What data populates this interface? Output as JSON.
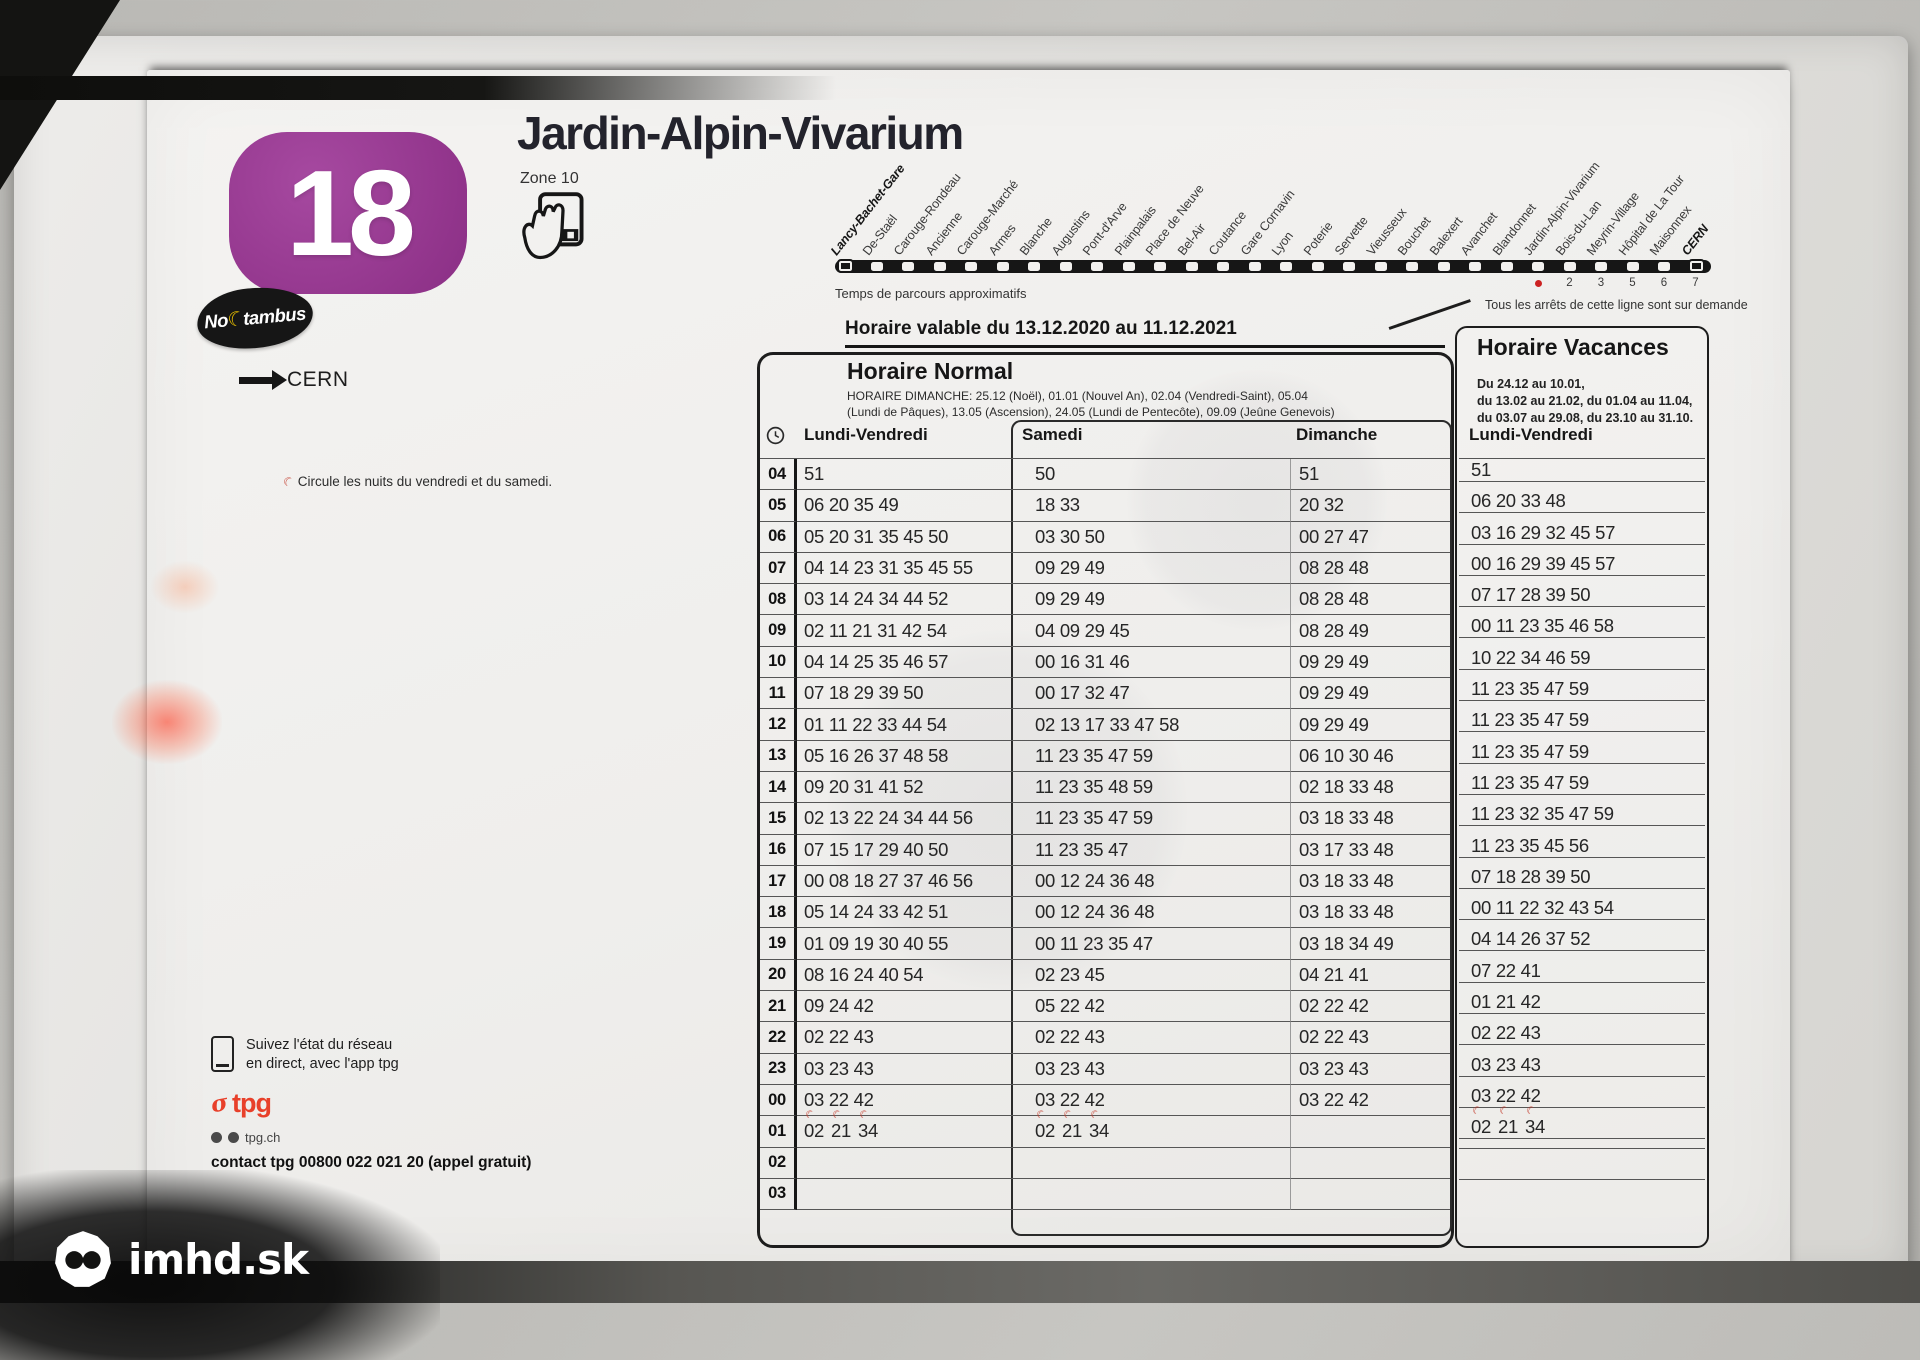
{
  "watermark": {
    "text": "imhd.sk"
  },
  "header": {
    "line_number": "18",
    "line_color": "#93368d",
    "title": "Jardin-Alpin-Vivarium",
    "zone": "Zone 10",
    "noctambus_prefix": "No",
    "noctambus_suffix": "tambus",
    "direction_label": "CERN",
    "night_note": "Circule les nuits du vendredi et du samedi."
  },
  "route": {
    "stops": [
      "Lancy-Bachet-Gare",
      "De-Staël",
      "Carouge-Rondeau",
      "Ancienne",
      "Carouge-Marché",
      "Armes",
      "Blanche",
      "Augustins",
      "Pont-d'Arve",
      "Plainpalais",
      "Place de Neuve",
      "Bel-Air",
      "Coutance",
      "Gare Cornavin",
      "Lyon",
      "Poterie",
      "Servette",
      "Vieusseux",
      "Bouchet",
      "Balexert",
      "Avanchet",
      "Blandonnet",
      "Jardin-Alpin-Vivarium",
      "Bois-du-Lan",
      "Meyrin-Village",
      "Hôpital de La Tour",
      "Maisonnex",
      "CERN"
    ],
    "travel_note": "Temps de parcours approximatifs",
    "minute_marks": [
      "•",
      "2",
      "3",
      "5",
      "6",
      "7"
    ],
    "demand_note": "Tous les arrêts de cette ligne sont sur demande"
  },
  "validity": "Horaire valable du 13.12.2020 au 11.12.2021",
  "normal": {
    "title": "Horaire Normal",
    "note_line1": "HORAIRE DIMANCHE: 25.12 (Noël), 01.01 (Nouvel An), 02.04 (Vendredi-Saint), 05.04",
    "note_line2": "(Lundi de Pâques), 13.05 (Ascension), 24.05 (Lundi de Pentecôte), 09.09 (Jeûne Genevois)"
  },
  "vacances": {
    "title": "Horaire Vacances",
    "dates_line1": "Du 24.12 au 10.01,",
    "dates_line2": "du 13.02 au 21.02, du 01.04 au 11.04,",
    "dates_line3": "du 03.07 au 29.08, du 23.10 au 31.10."
  },
  "timetable": {
    "col_lv": "Lundi-Vendredi",
    "col_sa": "Samedi",
    "col_di": "Dimanche",
    "col_vac": "Lundi-Vendredi",
    "rows": [
      {
        "hour": "04",
        "lv": "51",
        "sa": "50",
        "di": "51",
        "vac": "51"
      },
      {
        "hour": "05",
        "lv": "06 20 35 49",
        "sa": "18 33",
        "di": "20 32",
        "vac": "06 20 33 48"
      },
      {
        "hour": "06",
        "lv": "05 20 31 35 45 50",
        "sa": "03 30 50",
        "di": "00 27 47",
        "vac": "03 16 29 32 45 57"
      },
      {
        "hour": "07",
        "lv": "04 14 23 31 35 45 55",
        "sa": "09 29 49",
        "di": "08 28 48",
        "vac": "00 16 29 39 45 57"
      },
      {
        "hour": "08",
        "lv": "03 14 24 34 44 52",
        "sa": "09 29 49",
        "di": "08 28 48",
        "vac": "07 17 28 39 50"
      },
      {
        "hour": "09",
        "lv": "02 11 21 31 42 54",
        "sa": "04 09 29 45",
        "di": "08 28 49",
        "vac": "00 11 23 35 46 58"
      },
      {
        "hour": "10",
        "lv": "04 14 25 35 46 57",
        "sa": "00 16 31 46",
        "di": "09 29 49",
        "vac": "10 22 34 46 59"
      },
      {
        "hour": "11",
        "lv": "07 18 29 39 50",
        "sa": "00 17 32 47",
        "di": "09 29 49",
        "vac": "11 23 35 47 59"
      },
      {
        "hour": "12",
        "lv": "01 11 22 33 44 54",
        "sa": "02 13 17 33 47 58",
        "di": "09 29 49",
        "vac": "11 23 35 47 59"
      },
      {
        "hour": "13",
        "lv": "05 16 26 37 48 58",
        "sa": "11 23 35 47 59",
        "di": "06 10 30 46",
        "vac": "11 23 35 47 59"
      },
      {
        "hour": "14",
        "lv": "09 20 31 41 52",
        "sa": "11 23 35 48 59",
        "di": "02 18 33 48",
        "vac": "11 23 35 47 59"
      },
      {
        "hour": "15",
        "lv": "02 13 22 24 34 44 56",
        "sa": "11 23 35 47 59",
        "di": "03 18 33 48",
        "vac": "11 23 32 35 47 59"
      },
      {
        "hour": "16",
        "lv": "07 15 17 29 40 50",
        "sa": "11 23 35 47",
        "di": "03 17 33 48",
        "vac": "11 23 35 45 56"
      },
      {
        "hour": "17",
        "lv": "00 08 18 27 37 46 56",
        "sa": "00 12 24 36 48",
        "di": "03 18 33 48",
        "vac": "07 18 28 39 50"
      },
      {
        "hour": "18",
        "lv": "05 14 24 33 42 51",
        "sa": "00 12 24 36 48",
        "di": "03 18 33 48",
        "vac": "00 11 22 32 43 54"
      },
      {
        "hour": "19",
        "lv": "01 09 19 30 40 55",
        "sa": "00 11 23 35 47",
        "di": "03 18 34 49",
        "vac": "04 14 26 37 52"
      },
      {
        "hour": "20",
        "lv": "08 16 24 40 54",
        "sa": "02 23 45",
        "di": "04 21 41",
        "vac": "07 22 41"
      },
      {
        "hour": "21",
        "lv": "09 24 42",
        "sa": "05 22 42",
        "di": "02 22 42",
        "vac": "01 21 42"
      },
      {
        "hour": "22",
        "lv": "02 22 43",
        "sa": "02 22 43",
        "di": "02 22 43",
        "vac": "02 22 43"
      },
      {
        "hour": "23",
        "lv": "03 23 43",
        "sa": "03 23 43",
        "di": "03 23 43",
        "vac": "03 23 43"
      },
      {
        "hour": "00",
        "lv": "03 22 42",
        "sa": "03 22 42",
        "di": "03 22 42",
        "vac": "03 22 42"
      },
      {
        "hour": "01",
        "lv": "02 21 34",
        "sa": "02 21 34",
        "di": "",
        "vac": "02 21 34",
        "moon_lv": true,
        "moon_sa": true,
        "moon_vac": true
      },
      {
        "hour": "02",
        "lv": "",
        "sa": "",
        "di": "",
        "vac": ""
      },
      {
        "hour": "03",
        "lv": "",
        "sa": "",
        "di": "",
        "vac": ""
      }
    ]
  },
  "footer": {
    "app_note_line1": "Suivez l'état du réseau",
    "app_note_line2": "en direct, avec l'app tpg",
    "tpg_logo": "tpg",
    "tpg_symbol": "σ",
    "website": "tpg.ch",
    "contact": "contact tpg 00800 022 021 20 (appel gratuit)"
  }
}
